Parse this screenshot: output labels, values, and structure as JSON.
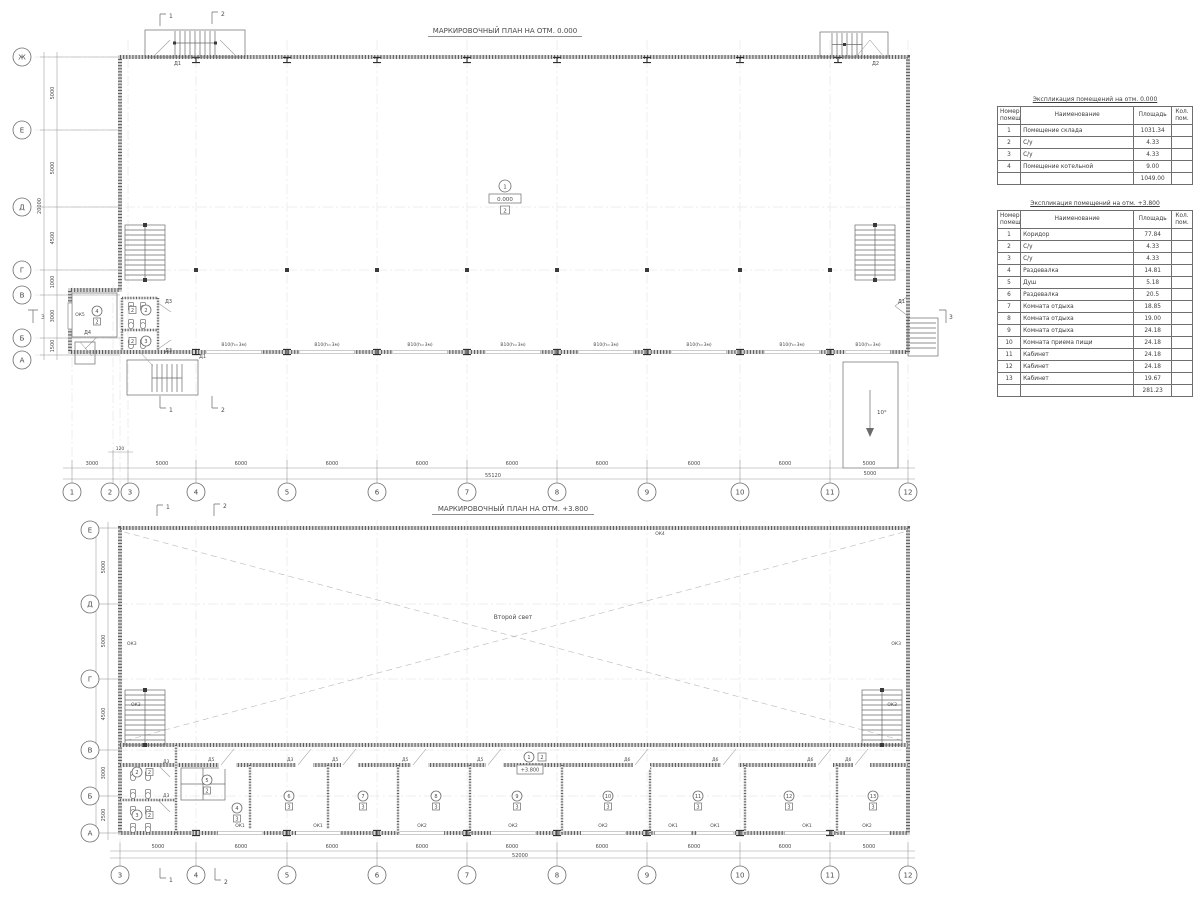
{
  "colors": {
    "background": "#ffffff",
    "line": "#5a5a5a",
    "wall": "#5f5f5f"
  },
  "nums": [
    "1",
    "2",
    "3",
    "4",
    "5",
    "6",
    "7",
    "8",
    "9",
    "10",
    "11",
    "12",
    "13"
  ],
  "letters": [
    "Ж",
    "Е",
    "Д",
    "Г",
    "В",
    "Б",
    "А"
  ],
  "doors": {
    "d1": "Д1",
    "d2": "Д2",
    "d3": "Д3",
    "d4": "Д4",
    "d5": "Д5",
    "d6": "Д6"
  },
  "windows": {
    "ok1": "ОК1",
    "ok2": "ОК2",
    "ok3": "ОК3",
    "ok4": "ОК4",
    "ok5": "ОК5"
  },
  "sections": {
    "s1": "1",
    "s2": "2",
    "s3": "3"
  },
  "dims": {
    "d120": "120",
    "d1000": "1000",
    "d1500": "1500",
    "d2500": "2500",
    "d3000": "3000",
    "d4500": "4500",
    "d5000": "5000",
    "d6000": "6000"
  },
  "cats": {
    "c2": "2",
    "c3": "3"
  },
  "plan1": {
    "title": "МАРКИРОВОЧНЫЙ ПЛАН НА ОТМ. 0.000",
    "total_width": "55120",
    "total_height": "20000",
    "opening_label": "В10(h=3м)",
    "ramp_angle": "10°",
    "ramp_width": "5000",
    "tag": {
      "num": "1",
      "elev": "0.000",
      "cat": "2"
    }
  },
  "plan2": {
    "title": "МАРКИРОВОЧНЫЙ ПЛАН НА ОТМ. +3.800",
    "second_light": "Второй свет",
    "total_width": "52000",
    "total_height": "20000",
    "tag": {
      "num": "1",
      "elev": "+3.800",
      "cat": "2"
    }
  },
  "tables": {
    "t1": {
      "title": "Экспликация помещений на отм. 0.000",
      "headers": {
        "num1": "Номер",
        "num2": "помещ.",
        "name": "Наименование",
        "area": "Площадь",
        "cnt1": "Кол.",
        "cnt2": "пом."
      },
      "rows": [
        {
          "num": "1",
          "name": "Помещение склада",
          "area": "1031.34",
          "count": ""
        },
        {
          "num": "2",
          "name": "С/у",
          "area": "4.33",
          "count": ""
        },
        {
          "num": "3",
          "name": "С/у",
          "area": "4.33",
          "count": ""
        },
        {
          "num": "4",
          "name": "Помещение котельной",
          "area": "9.00",
          "count": ""
        }
      ],
      "total": "1049.00"
    },
    "t2": {
      "title": "Экспликация помещений на отм. +3.800",
      "headers": {
        "num1": "Номер",
        "num2": "помещ.",
        "name": "Наименование",
        "area": "Площадь",
        "cnt1": "Кол.",
        "cnt2": "пом."
      },
      "rows": [
        {
          "num": "1",
          "name": "Коридор",
          "area": "77.84",
          "count": ""
        },
        {
          "num": "2",
          "name": "С/у",
          "area": "4.33",
          "count": ""
        },
        {
          "num": "3",
          "name": "С/у",
          "area": "4.33",
          "count": ""
        },
        {
          "num": "4",
          "name": "Раздевалка",
          "area": "14.81",
          "count": ""
        },
        {
          "num": "5",
          "name": "Душ",
          "area": "5.18",
          "count": ""
        },
        {
          "num": "6",
          "name": "Раздевалка",
          "area": "20.5",
          "count": ""
        },
        {
          "num": "7",
          "name": "Комната отдыха",
          "area": "18.85",
          "count": ""
        },
        {
          "num": "8",
          "name": "Комната отдыха",
          "area": "19.00",
          "count": ""
        },
        {
          "num": "9",
          "name": "Комната отдыха",
          "area": "24.18",
          "count": ""
        },
        {
          "num": "10",
          "name": "Комната приема пищи",
          "area": "24.18",
          "count": ""
        },
        {
          "num": "11",
          "name": "Кабинет",
          "area": "24.18",
          "count": ""
        },
        {
          "num": "12",
          "name": "Кабинет",
          "area": "24.18",
          "count": ""
        },
        {
          "num": "13",
          "name": "Кабинет",
          "area": "19.67",
          "count": ""
        }
      ],
      "total": "281.23"
    }
  }
}
